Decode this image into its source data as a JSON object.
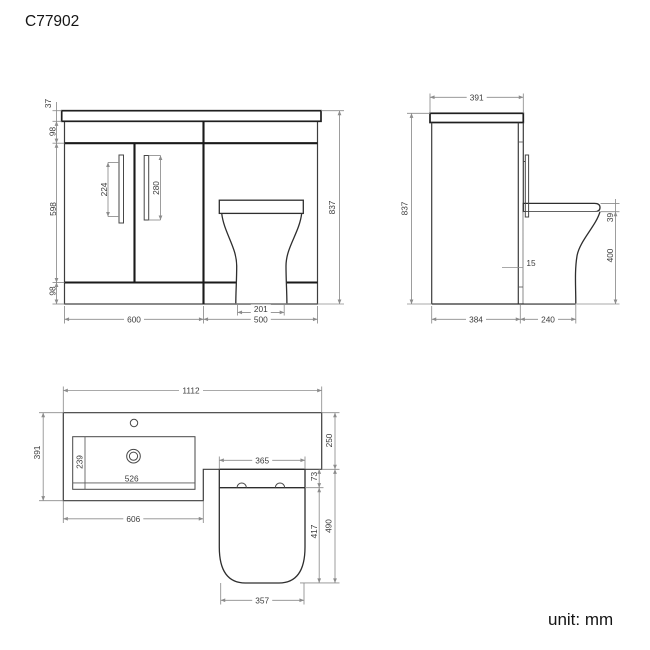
{
  "title": "C77902",
  "unit_label": "unit: mm",
  "colors": {
    "background": "#ffffff",
    "outline_dark": "#1f1f1f",
    "outline_medium": "#3d3d3d",
    "dimension_line": "#8c8c8c",
    "dimension_text": "#3c3c3c"
  },
  "front_view": {
    "worktop_thickness": "37",
    "top_rail_height": "98",
    "door_height": "598",
    "plinth_height": "98",
    "total_height": "837",
    "left_handle_length": "224",
    "right_handle_length": "280",
    "pan_base_width": "201",
    "vanity_width": "600",
    "wc_unit_width": "500"
  },
  "side_view": {
    "worktop_depth": "391",
    "total_height": "837",
    "seat_thickness": "39",
    "pan_height": "400",
    "back_panel_gap": "15",
    "cabinet_depth": "384",
    "pan_projection": "240"
  },
  "plan_view": {
    "total_width": "1112",
    "worktop_depth": "391",
    "bowl_depth": "239",
    "bowl_width": "526",
    "basin_unit_width": "606",
    "wc_worktop_depth": "250",
    "seat_width": "365",
    "seat_hinge_depth": "73",
    "seat_length": "417",
    "wc_total_depth": "490",
    "seat_front_width": "357"
  }
}
